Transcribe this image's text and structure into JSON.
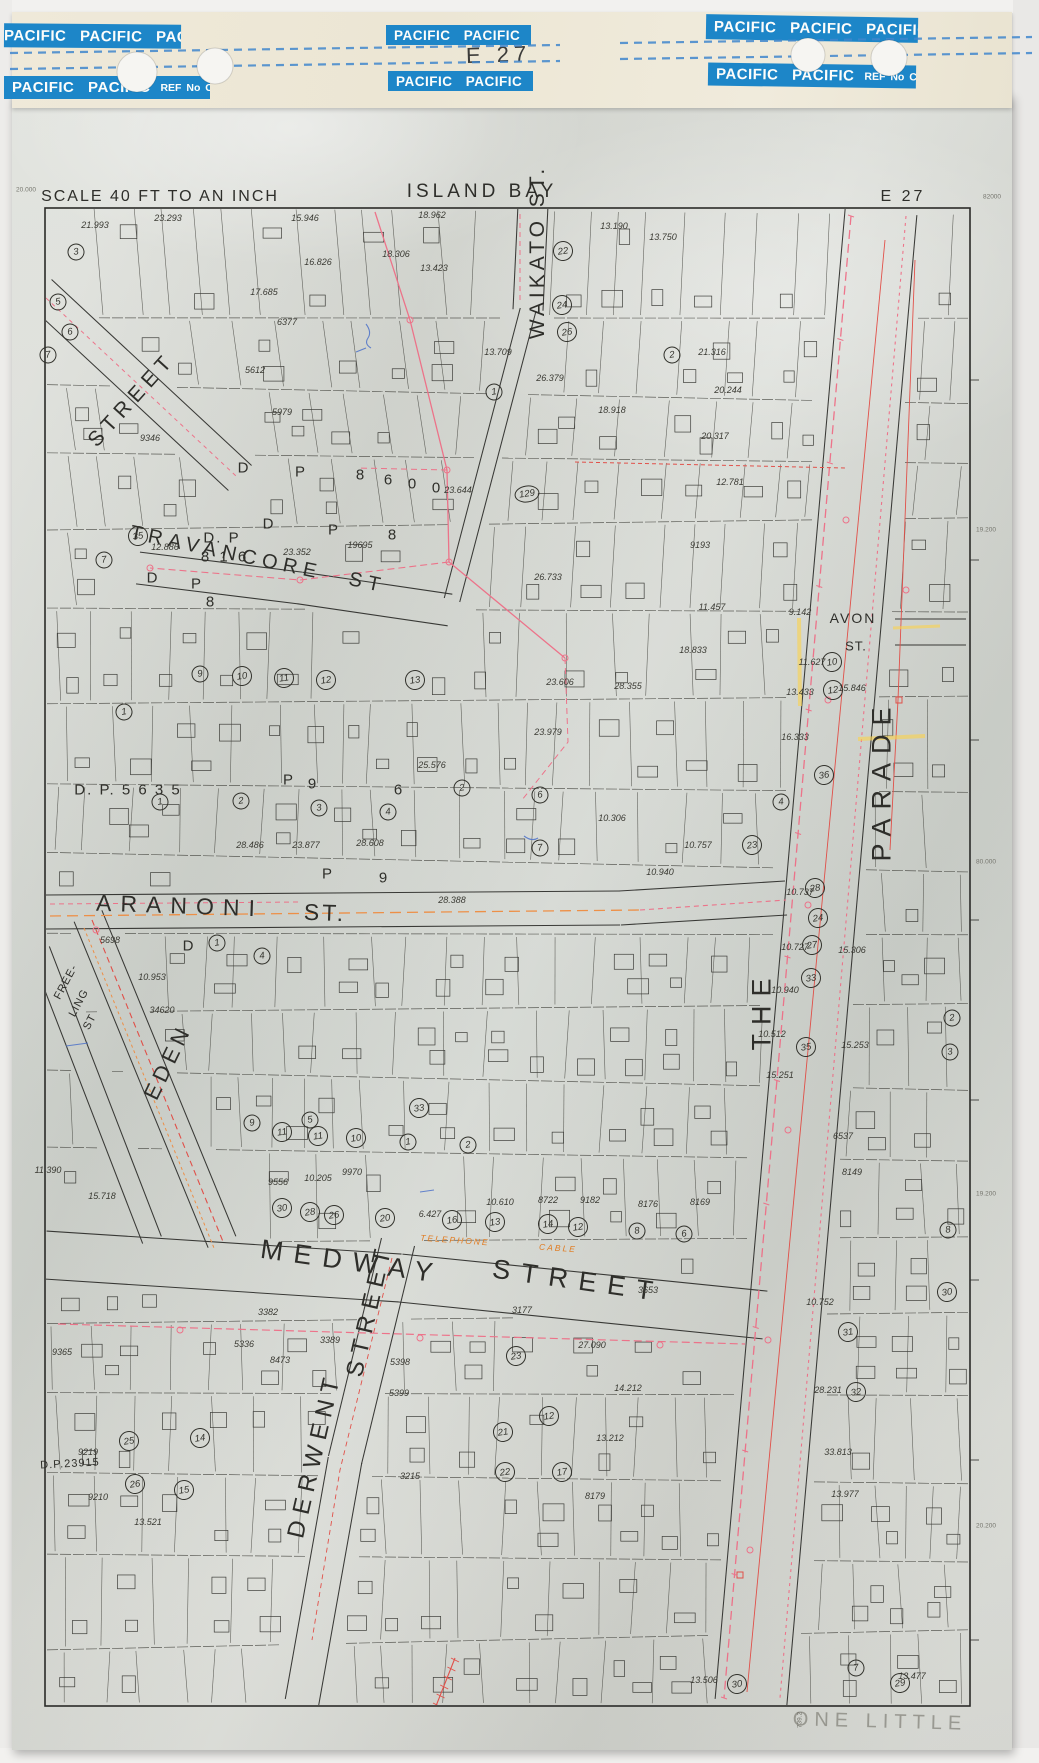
{
  "tapes": {
    "left_top": "PACIFIC PACIFIC PACIFIC",
    "left_bottom": "PACIFIC PACIFIC",
    "mid_top": "PACIFIC PACIFIC",
    "mid_bottom": "PACIFIC PACIFIC",
    "right_top": "PACIFIC PACIFIC PACIFIC",
    "right_bottom": "PACIFIC PACIFIC",
    "ref_label": "REF No CP 15",
    "sheet_code": "E 27"
  },
  "labels": {
    "header": [
      {
        "t": "SCALE 40 FT TO AN INCH",
        "x": 160,
        "y": 197,
        "r": 0,
        "fs": 16,
        "ls": 2
      },
      {
        "t": "ISLAND BAY",
        "x": 482,
        "y": 192,
        "r": 0,
        "fs": 19,
        "ls": 4
      },
      {
        "t": "E 27",
        "x": 903,
        "y": 197,
        "r": 0,
        "fs": 16,
        "ls": 3
      }
    ],
    "streets": [
      {
        "t": "STREET",
        "x": 132,
        "y": 400,
        "r": -48,
        "fs": 21,
        "ls": 6
      },
      {
        "t": "TRAVANCORE ST",
        "x": 258,
        "y": 560,
        "r": 12,
        "fs": 20,
        "ls": 6,
        "ws": 16
      },
      {
        "t": "WAIKATO ST.",
        "x": 538,
        "y": 252,
        "r": -90,
        "fs": 21,
        "ls": 4
      },
      {
        "t": "ARANONI",
        "x": 180,
        "y": 906,
        "r": 2,
        "fs": 23,
        "ls": 9
      },
      {
        "t": "ST.",
        "x": 325,
        "y": 913,
        "r": 2,
        "fs": 23,
        "ls": 3
      },
      {
        "t": "EDEN",
        "x": 168,
        "y": 1062,
        "r": -64,
        "fs": 22,
        "ls": 5
      },
      {
        "t": "FREE-",
        "x": 66,
        "y": 982,
        "r": -62,
        "fs": 11,
        "ls": 1
      },
      {
        "t": "LING",
        "x": 79,
        "y": 1003,
        "r": -62,
        "fs": 11,
        "ls": 1
      },
      {
        "t": "ST",
        "x": 90,
        "y": 1022,
        "r": -62,
        "fs": 11,
        "ls": 1
      },
      {
        "t": "MEDWAY",
        "x": 352,
        "y": 1262,
        "r": 8,
        "fs": 27,
        "ls": 11
      },
      {
        "t": "STREET",
        "x": 578,
        "y": 1281,
        "r": 8,
        "fs": 27,
        "ls": 11
      },
      {
        "t": "DERWENT",
        "x": 315,
        "y": 1455,
        "r": -77,
        "fs": 24,
        "ls": 7
      },
      {
        "t": "STREET",
        "x": 370,
        "y": 1310,
        "r": -77,
        "fs": 24,
        "ls": 7
      },
      {
        "t": "THE",
        "x": 762,
        "y": 1010,
        "r": -90,
        "fs": 27,
        "ls": 9
      },
      {
        "t": "PARADE",
        "x": 882,
        "y": 780,
        "r": -90,
        "fs": 27,
        "ls": 9
      },
      {
        "t": "AVON",
        "x": 853,
        "y": 618,
        "r": 0,
        "fs": 14,
        "ls": 2
      },
      {
        "t": "ST.",
        "x": 856,
        "y": 646,
        "r": 0,
        "fs": 13,
        "ls": 1
      }
    ],
    "dp": [
      {
        "t": "D. P",
        "x": 222,
        "y": 538,
        "fs": 15,
        "ls": 2
      },
      {
        "t": "8 1 6",
        "x": 225,
        "y": 557,
        "fs": 15,
        "ls": 3
      },
      {
        "t": "D. P.  5 6 3 5",
        "x": 128,
        "y": 790,
        "fs": 15,
        "ls": 2
      },
      {
        "t": "D.P.23915",
        "x": 70,
        "y": 1464,
        "fs": 11,
        "ls": 1,
        "r": -3
      }
    ],
    "letters": [
      {
        "t": "D",
        "x": 243,
        "y": 468
      },
      {
        "t": "P",
        "x": 300,
        "y": 472
      },
      {
        "t": "8",
        "x": 360,
        "y": 475
      },
      {
        "t": "6",
        "x": 388,
        "y": 480
      },
      {
        "t": "0",
        "x": 412,
        "y": 484
      },
      {
        "t": "0",
        "x": 436,
        "y": 488
      },
      {
        "t": "D",
        "x": 268,
        "y": 524
      },
      {
        "t": "P",
        "x": 333,
        "y": 530
      },
      {
        "t": "8",
        "x": 392,
        "y": 535
      },
      {
        "t": "D",
        "x": 188,
        "y": 946
      },
      {
        "t": "P",
        "x": 327,
        "y": 874
      },
      {
        "t": "9",
        "x": 383,
        "y": 878
      },
      {
        "t": "D",
        "x": 152,
        "y": 578
      },
      {
        "t": "P",
        "x": 196,
        "y": 584
      },
      {
        "t": "8",
        "x": 210,
        "y": 602
      },
      {
        "t": "P",
        "x": 288,
        "y": 780
      },
      {
        "t": "9",
        "x": 312,
        "y": 784
      },
      {
        "t": "6",
        "x": 398,
        "y": 790
      }
    ],
    "areas": [
      {
        "t": "21.993",
        "x": 95,
        "y": 225
      },
      {
        "t": "23.293",
        "x": 168,
        "y": 218
      },
      {
        "t": "15.946",
        "x": 305,
        "y": 218
      },
      {
        "t": "18.962",
        "x": 432,
        "y": 215
      },
      {
        "t": "13.190",
        "x": 614,
        "y": 226
      },
      {
        "t": "13.750",
        "x": 663,
        "y": 237
      },
      {
        "t": "16.826",
        "x": 318,
        "y": 262
      },
      {
        "t": "18.306",
        "x": 396,
        "y": 254
      },
      {
        "t": "13.423",
        "x": 434,
        "y": 268
      },
      {
        "t": "17.685",
        "x": 264,
        "y": 292
      },
      {
        "t": "6377",
        "x": 287,
        "y": 322
      },
      {
        "t": "5612",
        "x": 255,
        "y": 370
      },
      {
        "t": "5979",
        "x": 282,
        "y": 412
      },
      {
        "t": "9346",
        "x": 150,
        "y": 438
      },
      {
        "t": "12.886",
        "x": 165,
        "y": 547
      },
      {
        "t": "23.352",
        "x": 297,
        "y": 552
      },
      {
        "t": "19695",
        "x": 360,
        "y": 545
      },
      {
        "t": "13.709",
        "x": 498,
        "y": 352
      },
      {
        "t": "26.379",
        "x": 550,
        "y": 378
      },
      {
        "t": "18.918",
        "x": 612,
        "y": 410
      },
      {
        "t": "21.316",
        "x": 712,
        "y": 352
      },
      {
        "t": "20.244",
        "x": 728,
        "y": 390
      },
      {
        "t": "20.317",
        "x": 715,
        "y": 436
      },
      {
        "t": "23.644",
        "x": 458,
        "y": 490
      },
      {
        "t": "12.781",
        "x": 730,
        "y": 482
      },
      {
        "t": "26.733",
        "x": 548,
        "y": 577
      },
      {
        "t": "9193",
        "x": 700,
        "y": 545
      },
      {
        "t": "11.457",
        "x": 712,
        "y": 607
      },
      {
        "t": "18.833",
        "x": 693,
        "y": 650
      },
      {
        "t": "15.846",
        "x": 852,
        "y": 688
      },
      {
        "t": "28.355",
        "x": 628,
        "y": 686
      },
      {
        "t": "23.606",
        "x": 560,
        "y": 682
      },
      {
        "t": "23.979",
        "x": 548,
        "y": 732
      },
      {
        "t": "25.576",
        "x": 432,
        "y": 765
      },
      {
        "t": "28.486",
        "x": 250,
        "y": 845
      },
      {
        "t": "23.877",
        "x": 306,
        "y": 845
      },
      {
        "t": "28.608",
        "x": 370,
        "y": 843
      },
      {
        "t": "28.388",
        "x": 452,
        "y": 900
      },
      {
        "t": "10.306",
        "x": 612,
        "y": 818
      },
      {
        "t": "10.757",
        "x": 698,
        "y": 845
      },
      {
        "t": "10.940",
        "x": 660,
        "y": 872
      },
      {
        "t": "5698",
        "x": 110,
        "y": 940
      },
      {
        "t": "10.953",
        "x": 152,
        "y": 977
      },
      {
        "t": "34620",
        "x": 162,
        "y": 1010
      },
      {
        "t": "9.142",
        "x": 800,
        "y": 612
      },
      {
        "t": "11.627",
        "x": 812,
        "y": 662
      },
      {
        "t": "13.433",
        "x": 800,
        "y": 692
      },
      {
        "t": "16.333",
        "x": 795,
        "y": 737
      },
      {
        "t": "10.737",
        "x": 800,
        "y": 892
      },
      {
        "t": "10.727",
        "x": 795,
        "y": 947
      },
      {
        "t": "10.940",
        "x": 785,
        "y": 990
      },
      {
        "t": "10.512",
        "x": 772,
        "y": 1034
      },
      {
        "t": "15.251",
        "x": 780,
        "y": 1075
      },
      {
        "t": "15.306",
        "x": 852,
        "y": 950
      },
      {
        "t": "15.253",
        "x": 855,
        "y": 1045
      },
      {
        "t": "6537",
        "x": 843,
        "y": 1136
      },
      {
        "t": "8149",
        "x": 852,
        "y": 1172
      },
      {
        "t": "11.390",
        "x": 48,
        "y": 1170
      },
      {
        "t": "15.718",
        "x": 102,
        "y": 1196
      },
      {
        "t": "9556",
        "x": 278,
        "y": 1182
      },
      {
        "t": "10.205",
        "x": 318,
        "y": 1178
      },
      {
        "t": "9970",
        "x": 352,
        "y": 1172
      },
      {
        "t": "6.427",
        "x": 430,
        "y": 1214
      },
      {
        "t": "10.610",
        "x": 500,
        "y": 1202
      },
      {
        "t": "8722",
        "x": 548,
        "y": 1200
      },
      {
        "t": "9182",
        "x": 590,
        "y": 1200
      },
      {
        "t": "8176",
        "x": 648,
        "y": 1204
      },
      {
        "t": "8169",
        "x": 700,
        "y": 1202
      },
      {
        "t": "3382",
        "x": 268,
        "y": 1312
      },
      {
        "t": "5336",
        "x": 244,
        "y": 1344
      },
      {
        "t": "3389",
        "x": 330,
        "y": 1340
      },
      {
        "t": "8473",
        "x": 280,
        "y": 1360
      },
      {
        "t": "5398",
        "x": 400,
        "y": 1362
      },
      {
        "t": "5399",
        "x": 399,
        "y": 1393
      },
      {
        "t": "3215",
        "x": 410,
        "y": 1476
      },
      {
        "t": "3653",
        "x": 648,
        "y": 1290
      },
      {
        "t": "27.090",
        "x": 592,
        "y": 1345
      },
      {
        "t": "14.212",
        "x": 628,
        "y": 1388
      },
      {
        "t": "13.212",
        "x": 610,
        "y": 1438
      },
      {
        "t": "8179",
        "x": 595,
        "y": 1496
      },
      {
        "t": "3177",
        "x": 522,
        "y": 1310
      },
      {
        "t": "9219",
        "x": 88,
        "y": 1452
      },
      {
        "t": "9210",
        "x": 98,
        "y": 1497
      },
      {
        "t": "13.521",
        "x": 148,
        "y": 1522
      },
      {
        "t": "9365",
        "x": 62,
        "y": 1352
      },
      {
        "t": "10.752",
        "x": 820,
        "y": 1302
      },
      {
        "t": "28.231",
        "x": 828,
        "y": 1390
      },
      {
        "t": "33.813",
        "x": 838,
        "y": 1452
      },
      {
        "t": "13.977",
        "x": 845,
        "y": 1494
      },
      {
        "t": "13.477",
        "x": 912,
        "y": 1676
      },
      {
        "t": "13.506",
        "x": 704,
        "y": 1680
      }
    ],
    "lots": [
      {
        "n": "3",
        "x": 76,
        "y": 252
      },
      {
        "n": "5",
        "x": 58,
        "y": 302
      },
      {
        "n": "6",
        "x": 70,
        "y": 332
      },
      {
        "n": "7",
        "x": 48,
        "y": 355
      },
      {
        "n": "22",
        "x": 563,
        "y": 251
      },
      {
        "n": "24",
        "x": 562,
        "y": 305
      },
      {
        "n": "26",
        "x": 567,
        "y": 332
      },
      {
        "n": "2",
        "x": 672,
        "y": 355
      },
      {
        "n": "1",
        "x": 494,
        "y": 392
      },
      {
        "n": "129",
        "x": 527,
        "y": 494
      },
      {
        "n": "35",
        "x": 138,
        "y": 536
      },
      {
        "n": "7",
        "x": 104,
        "y": 560
      },
      {
        "n": "9",
        "x": 200,
        "y": 674
      },
      {
        "n": "10",
        "x": 242,
        "y": 676
      },
      {
        "n": "11",
        "x": 284,
        "y": 678
      },
      {
        "n": "12",
        "x": 326,
        "y": 680
      },
      {
        "n": "13",
        "x": 415,
        "y": 680
      },
      {
        "n": "1",
        "x": 124,
        "y": 712
      },
      {
        "n": "1",
        "x": 160,
        "y": 802
      },
      {
        "n": "2",
        "x": 241,
        "y": 801
      },
      {
        "n": "3",
        "x": 319,
        "y": 808
      },
      {
        "n": "4",
        "x": 388,
        "y": 812
      },
      {
        "n": "2",
        "x": 462,
        "y": 788
      },
      {
        "n": "6",
        "x": 540,
        "y": 795
      },
      {
        "n": "7",
        "x": 540,
        "y": 848
      },
      {
        "n": "1",
        "x": 217,
        "y": 943
      },
      {
        "n": "4",
        "x": 262,
        "y": 956
      },
      {
        "n": "10",
        "x": 832,
        "y": 662
      },
      {
        "n": "12",
        "x": 833,
        "y": 690
      },
      {
        "n": "36",
        "x": 824,
        "y": 775
      },
      {
        "n": "4",
        "x": 781,
        "y": 802
      },
      {
        "n": "23",
        "x": 752,
        "y": 845
      },
      {
        "n": "28",
        "x": 815,
        "y": 888
      },
      {
        "n": "24",
        "x": 818,
        "y": 918
      },
      {
        "n": "27",
        "x": 812,
        "y": 945
      },
      {
        "n": "33",
        "x": 811,
        "y": 978
      },
      {
        "n": "35",
        "x": 806,
        "y": 1047
      },
      {
        "n": "2",
        "x": 952,
        "y": 1018
      },
      {
        "n": "3",
        "x": 950,
        "y": 1052
      },
      {
        "n": "8",
        "x": 948,
        "y": 1230
      },
      {
        "n": "30",
        "x": 947,
        "y": 1292
      },
      {
        "n": "33",
        "x": 419,
        "y": 1108
      },
      {
        "n": "9",
        "x": 252,
        "y": 1123
      },
      {
        "n": "11",
        "x": 282,
        "y": 1132
      },
      {
        "n": "5",
        "x": 310,
        "y": 1120
      },
      {
        "n": "11",
        "x": 318,
        "y": 1136
      },
      {
        "n": "10",
        "x": 356,
        "y": 1138
      },
      {
        "n": "1",
        "x": 408,
        "y": 1142
      },
      {
        "n": "2",
        "x": 468,
        "y": 1145
      },
      {
        "n": "30",
        "x": 282,
        "y": 1208
      },
      {
        "n": "28",
        "x": 310,
        "y": 1212
      },
      {
        "n": "26",
        "x": 334,
        "y": 1215
      },
      {
        "n": "20",
        "x": 385,
        "y": 1218
      },
      {
        "n": "16",
        "x": 452,
        "y": 1220
      },
      {
        "n": "13",
        "x": 495,
        "y": 1222
      },
      {
        "n": "14",
        "x": 548,
        "y": 1224
      },
      {
        "n": "12",
        "x": 578,
        "y": 1227
      },
      {
        "n": "8",
        "x": 637,
        "y": 1231
      },
      {
        "n": "6",
        "x": 684,
        "y": 1234
      },
      {
        "n": "25",
        "x": 129,
        "y": 1441
      },
      {
        "n": "26",
        "x": 135,
        "y": 1484
      },
      {
        "n": "14",
        "x": 200,
        "y": 1438
      },
      {
        "n": "15",
        "x": 184,
        "y": 1490
      },
      {
        "n": "23",
        "x": 516,
        "y": 1356
      },
      {
        "n": "21",
        "x": 503,
        "y": 1432
      },
      {
        "n": "22",
        "x": 505,
        "y": 1472
      },
      {
        "n": "12",
        "x": 549,
        "y": 1416
      },
      {
        "n": "17",
        "x": 562,
        "y": 1472
      },
      {
        "n": "31",
        "x": 848,
        "y": 1332
      },
      {
        "n": "32",
        "x": 856,
        "y": 1392
      },
      {
        "n": "29",
        "x": 900,
        "y": 1683
      },
      {
        "n": "7",
        "x": 856,
        "y": 1668
      },
      {
        "n": "30",
        "x": 737,
        "y": 1684
      }
    ],
    "margin_marks": [
      {
        "t": "82000",
        "x": 992,
        "y": 197
      },
      {
        "t": "19.200",
        "x": 986,
        "y": 530
      },
      {
        "t": "80.000",
        "x": 986,
        "y": 862
      },
      {
        "t": "19.200",
        "x": 986,
        "y": 1194
      },
      {
        "t": "20.200",
        "x": 986,
        "y": 1526
      },
      {
        "t": "20.000",
        "x": 26,
        "y": 190
      },
      {
        "t": "739.2",
        "x": 800,
        "y": 1720,
        "r": -90
      }
    ]
  },
  "notes": {
    "pencil": "ONE LITTLE",
    "telephone": "TELEPHONE",
    "cable": "CABLE"
  },
  "colors": {
    "tape_blue": "#1d86c8",
    "dash_blue": "#3f86cc",
    "ink": "#32322d",
    "survey_pink": "#ef6b84",
    "survey_red": "#e2453e",
    "survey_orange": "#f08a3c",
    "highlight_yellow": "#ffd23f"
  }
}
